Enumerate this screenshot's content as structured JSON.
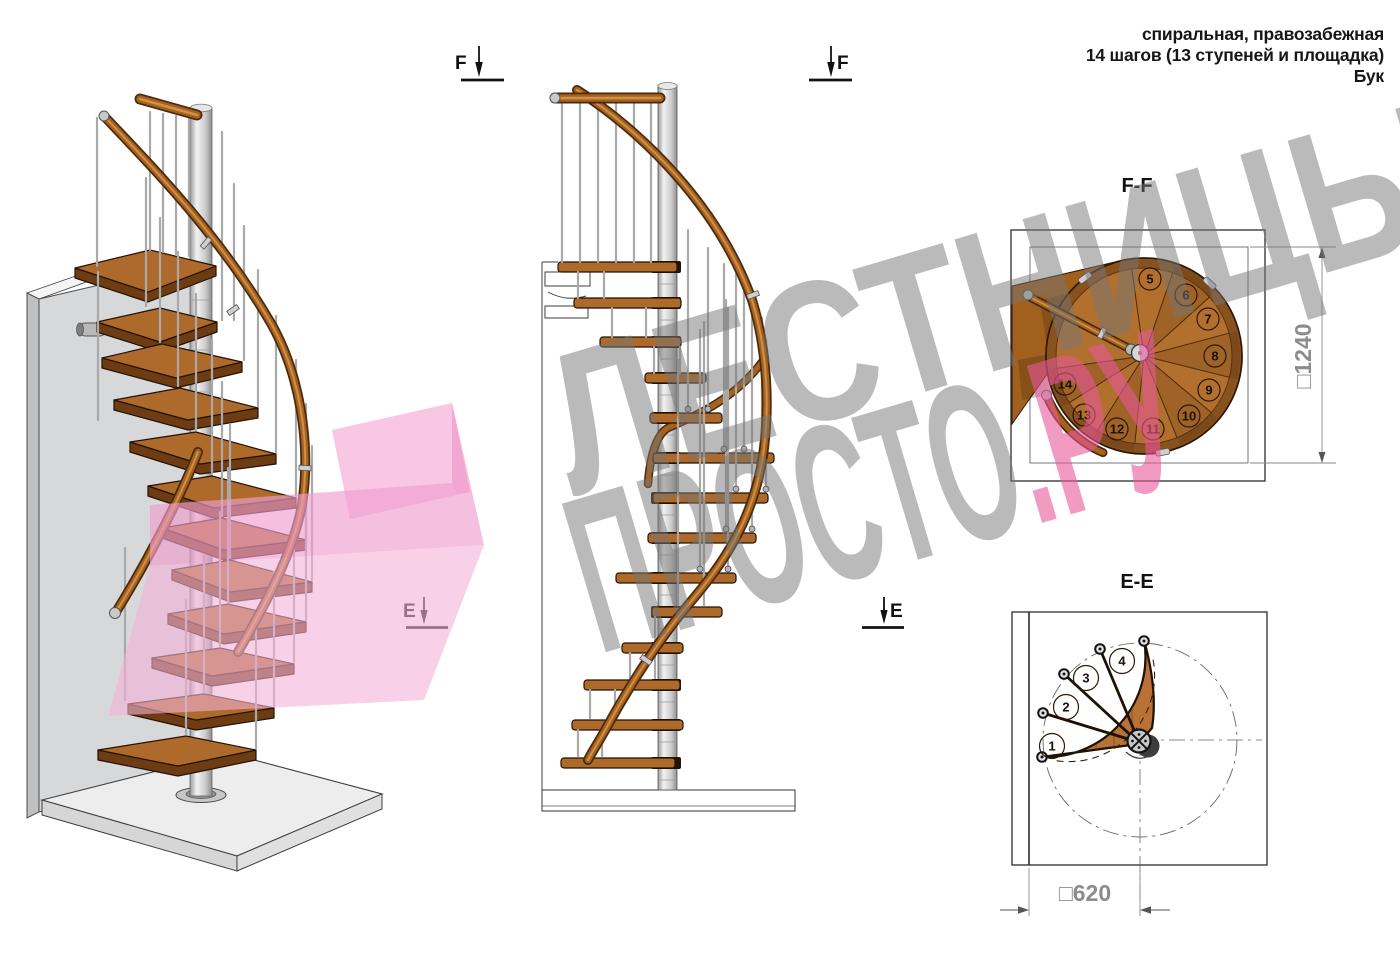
{
  "header": {
    "line1": "спиральная, правозабежная",
    "line2": "14 шагов (13 ступеней и площадка)",
    "line3": "Бук"
  },
  "watermark": {
    "line1": "ЛЕСТНИЦЫ",
    "line2_gray": "ПРОСТО",
    "line2_pink": ".РУ"
  },
  "markers": {
    "f_label": "F",
    "e_label": "E"
  },
  "sections": {
    "ff": {
      "title": "F-F",
      "dimension": "□1240",
      "step_numbers": [
        "5",
        "6",
        "7",
        "8",
        "9",
        "10",
        "11",
        "12",
        "13",
        "14"
      ]
    },
    "ee": {
      "title": "E-E",
      "dimension": "□620",
      "step_numbers": [
        "1",
        "2",
        "3",
        "4"
      ]
    }
  },
  "colors": {
    "wood": "#ad6a2a",
    "wood_dark": "#6e3c12",
    "steel": "#c9c9c9",
    "pink_watermark": "#e8569a",
    "gray_watermark": "#767676",
    "line": "#2d2d2d"
  }
}
